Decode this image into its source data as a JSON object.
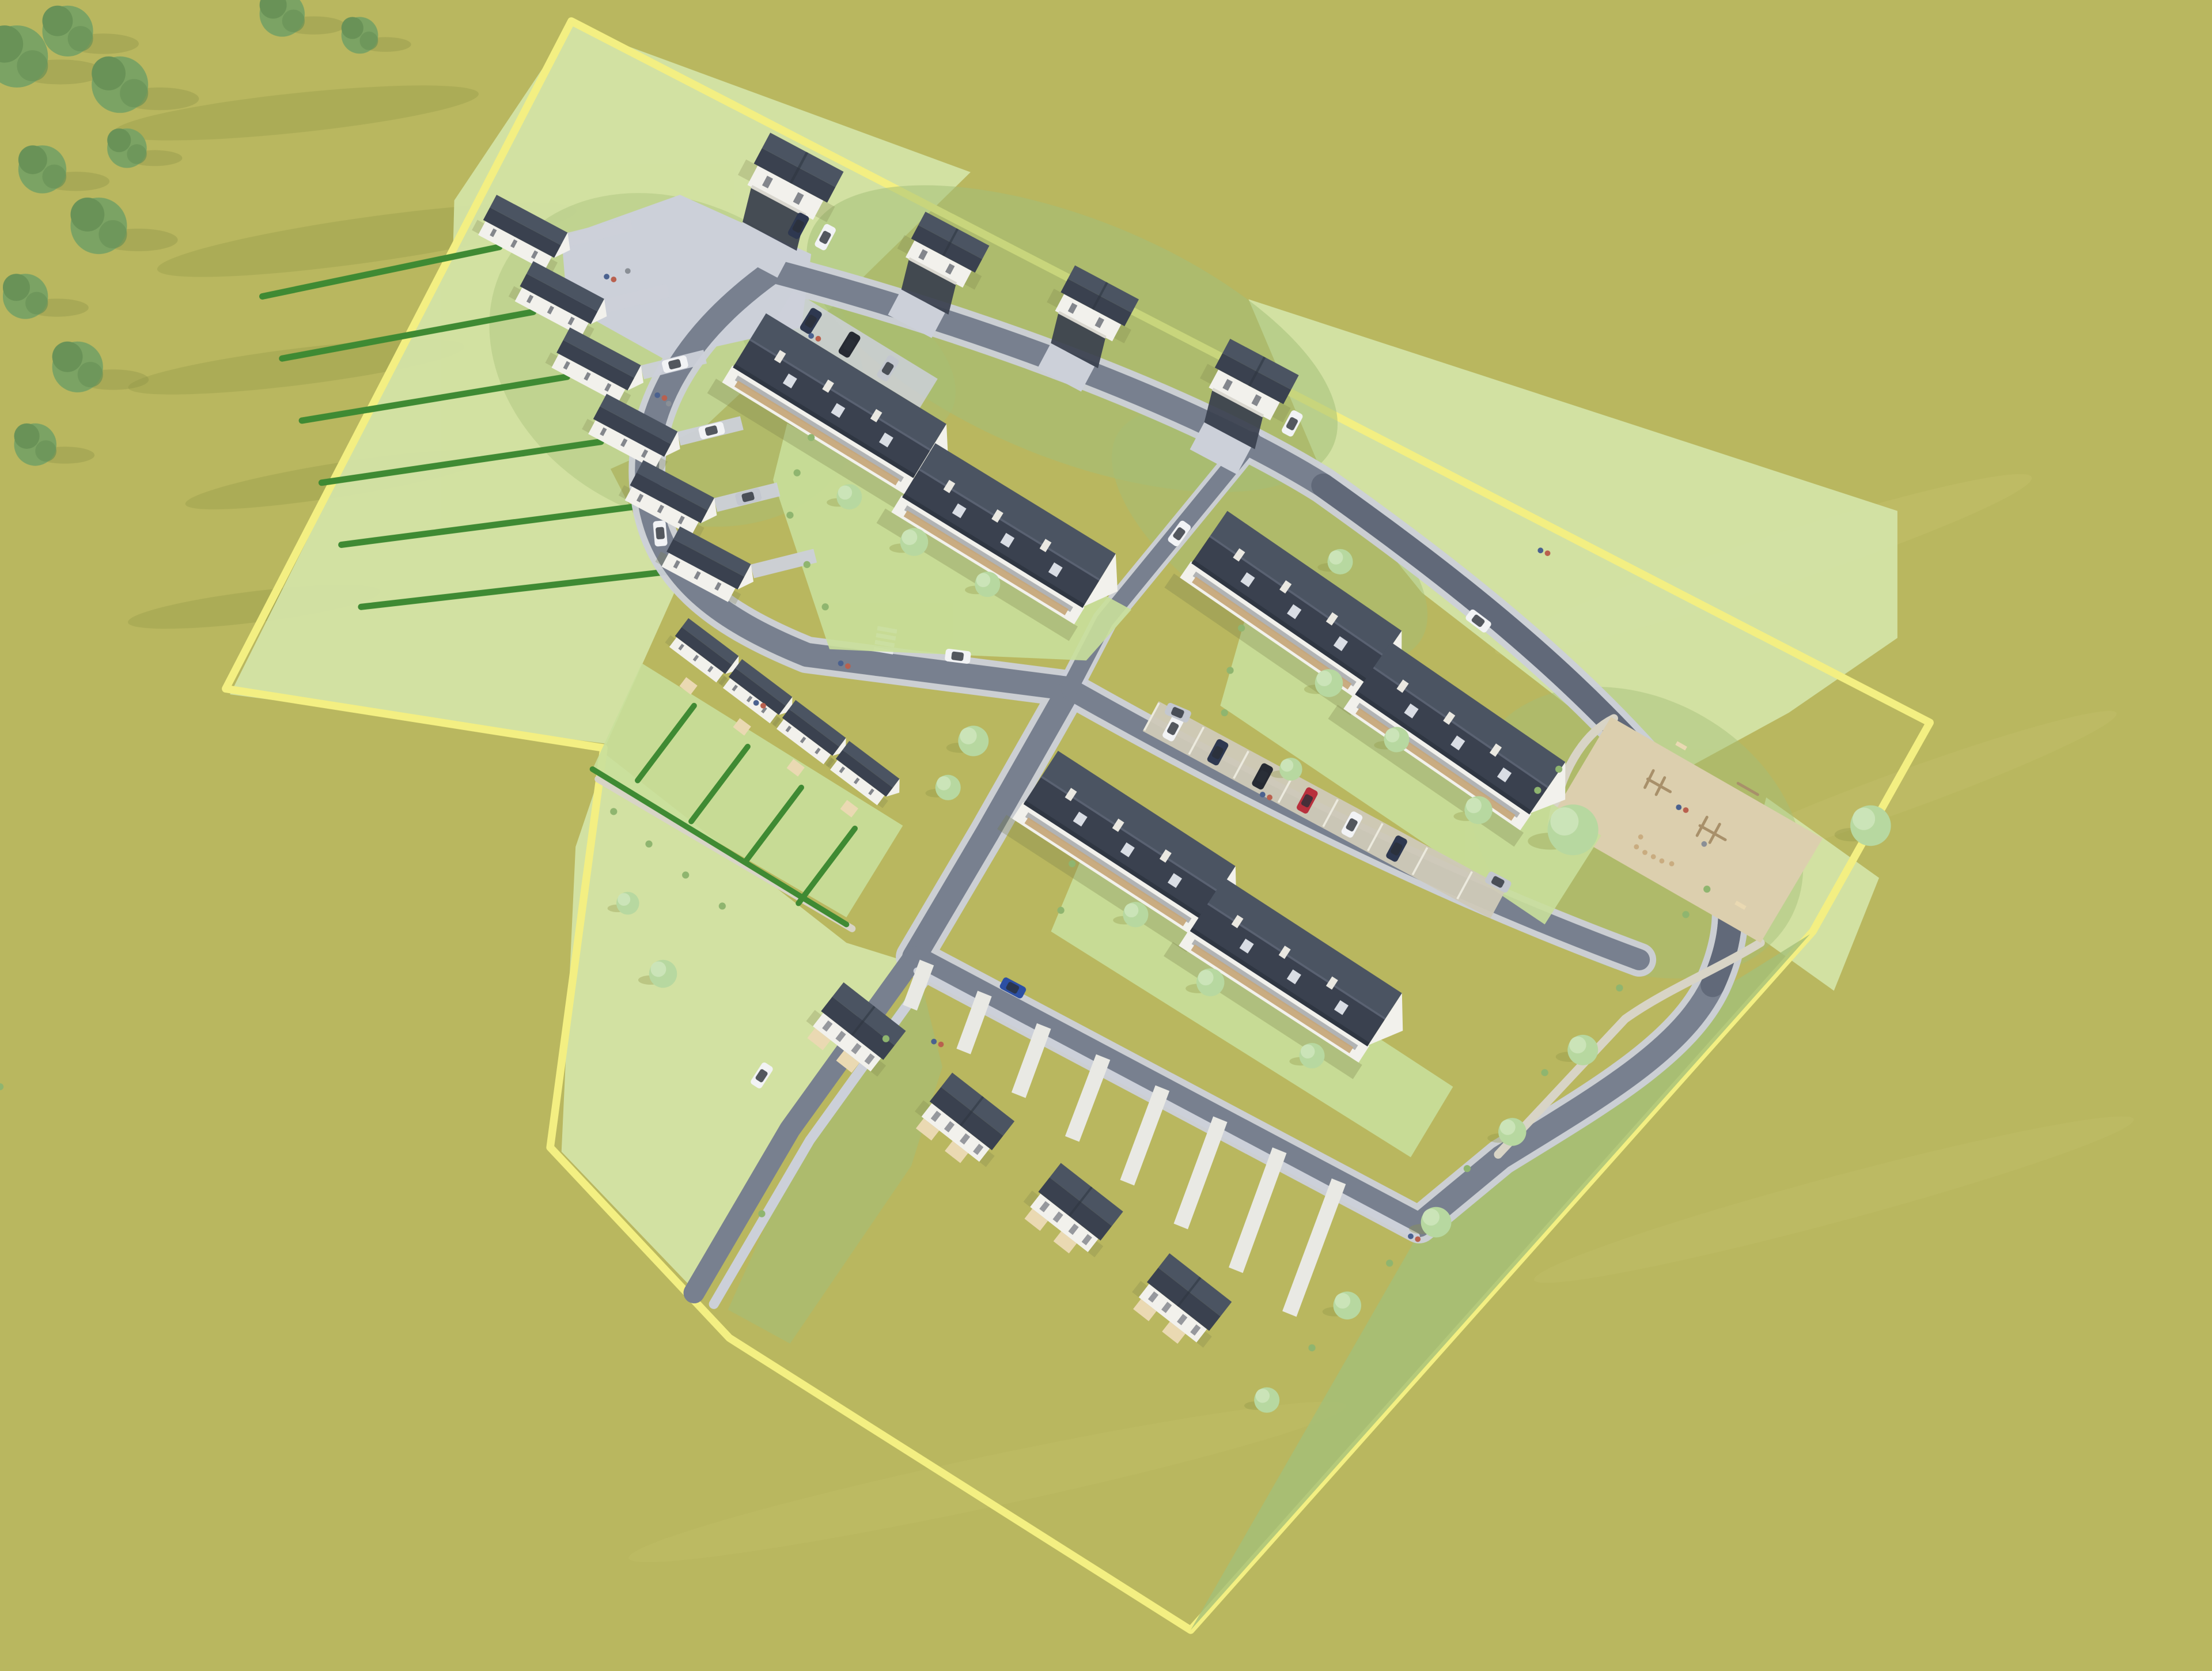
{
  "site": {
    "description": "Aerial 3D rendering of a planned suburban housing estate: three long apartment blocks with dark gabled roofs and wooden balconies, a staggered row of six terraced houses with driveways, four detached houses with carports, a row of four terraced garden houses, four semi-detached houses, a sandy playground, parking bays with cars, lawns, hedges and trees, all inside a plot outlined by a pale yellow boundary line on an olive-green field"
  },
  "inventory": {
    "apartment_blocks": 3,
    "terraced_houses_northwest_row": 6,
    "detached_houses_with_carports": 4,
    "terraced_garden_houses_west_row": 4,
    "semi_detached_houses_south_row": 4,
    "playground": 1,
    "parking_bays_row": 8,
    "cars_visible": 23,
    "car_colors_seen": [
      "white",
      "silver",
      "black",
      "dark-blue",
      "red",
      "maroon",
      "blue"
    ],
    "boundary_outline": "pale-yellow",
    "people_visible": true
  },
  "colors": {
    "ground": "#b9b75f",
    "groundShadow": "#9da14f",
    "groundLight": "#c9c671",
    "boundary": "#f3ef82",
    "lawn": "#d4e4a8",
    "lawnBright": "#c9df9b",
    "grass": "#a4bf78",
    "hedge": "#3f8a33",
    "road": "#78808f",
    "roadDark": "#5d6575",
    "sidewalk": "#ccd0d9",
    "paving": "#cfc9b8",
    "gravel": "#d8d4c6",
    "roofDark": "#3a414f",
    "roofLight": "#4b5462",
    "wall": "#f2f1ec",
    "balcony": "#c6a87b",
    "sand": "#dccfae",
    "wood": "#a8906a",
    "treeLight": "#b7d8a0",
    "treeLighter": "#cfe6bc",
    "treeDark": "#7ba364",
    "treeDarker": "#699257",
    "shadowTint": "#777d49",
    "carWhite": "#f2f3f5",
    "carSilver": "#c3c7cf",
    "carBlack": "#262a33",
    "carDarkBlue": "#2e3850",
    "carRed": "#b8303d",
    "carMaroon": "#8e2737",
    "carBlue": "#2c4fa3",
    "personA": "#4a618f",
    "personB": "#b9604e"
  }
}
